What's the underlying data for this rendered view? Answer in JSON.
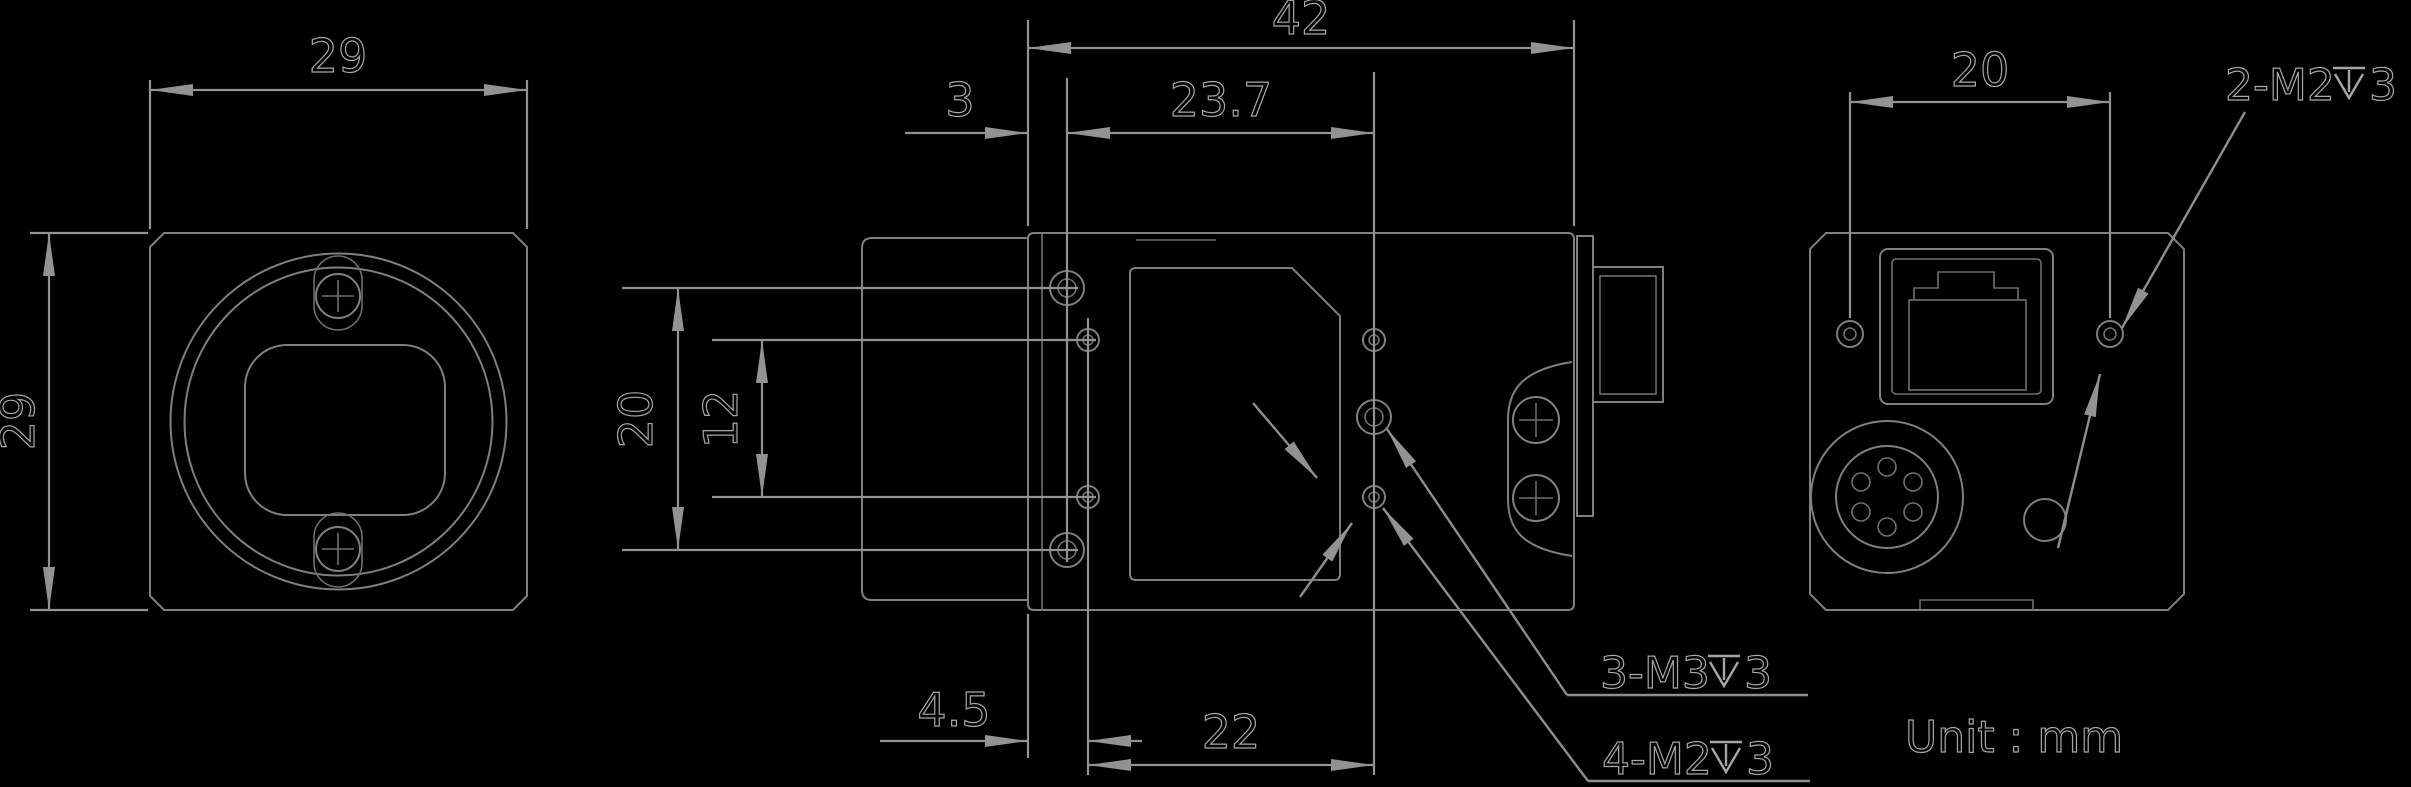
{
  "title": "camera-outline-dimension-drawing",
  "unit_note": "Unit : mm",
  "front_view": {
    "width": "29",
    "height": "29"
  },
  "side_view": {
    "length": "42",
    "front_hole_offset": "3",
    "top_hole_span": "23.7",
    "side_hole_row_span": "20",
    "side_hole_inner_span": "12",
    "bottom_front_offset": "4.5",
    "bottom_hole_span": "22",
    "m3_label_prefix": "3-M3",
    "m3_label_depth": "3",
    "m2_label_prefix": "4-M2",
    "m2_label_depth": "3",
    "depth_symbol": "depth-symbol"
  },
  "back_view": {
    "hole_span": "20",
    "m2_label_prefix": "2-M2",
    "m2_label_depth": "3",
    "depth_symbol": "depth-symbol"
  },
  "colors": {
    "background": "#000000",
    "part_line": "#7f7f7f",
    "dimension_line": "#929292",
    "text_fill": "#030303",
    "text_outline": "#a6a6a6"
  }
}
